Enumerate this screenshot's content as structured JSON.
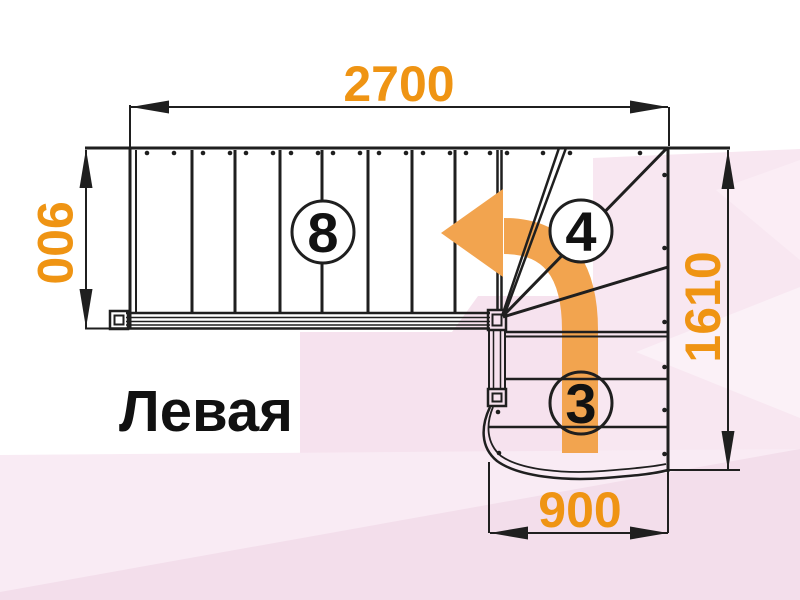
{
  "diagram": {
    "title": "Левая",
    "dimensions": {
      "top": "2700",
      "left": "900",
      "right": "1610",
      "bottom": "900"
    },
    "step_counts": {
      "upper_flight": "8",
      "winder": "4",
      "lower_flight": "3"
    },
    "colors": {
      "line_black": "#1f1f1f",
      "dimension_orange": "#ef9413",
      "arrow_orange": "#f2a44f",
      "bg_pink_right": "#f8e7f1",
      "bg_pink_mid": "#f6e2ee",
      "bg_pink_bottom": "#f9ebf4",
      "bg_pink_deep": "#f3deeb",
      "bg_pink_light": "#fcf2f8",
      "bg_pink_faint": "#fbeff6"
    }
  }
}
